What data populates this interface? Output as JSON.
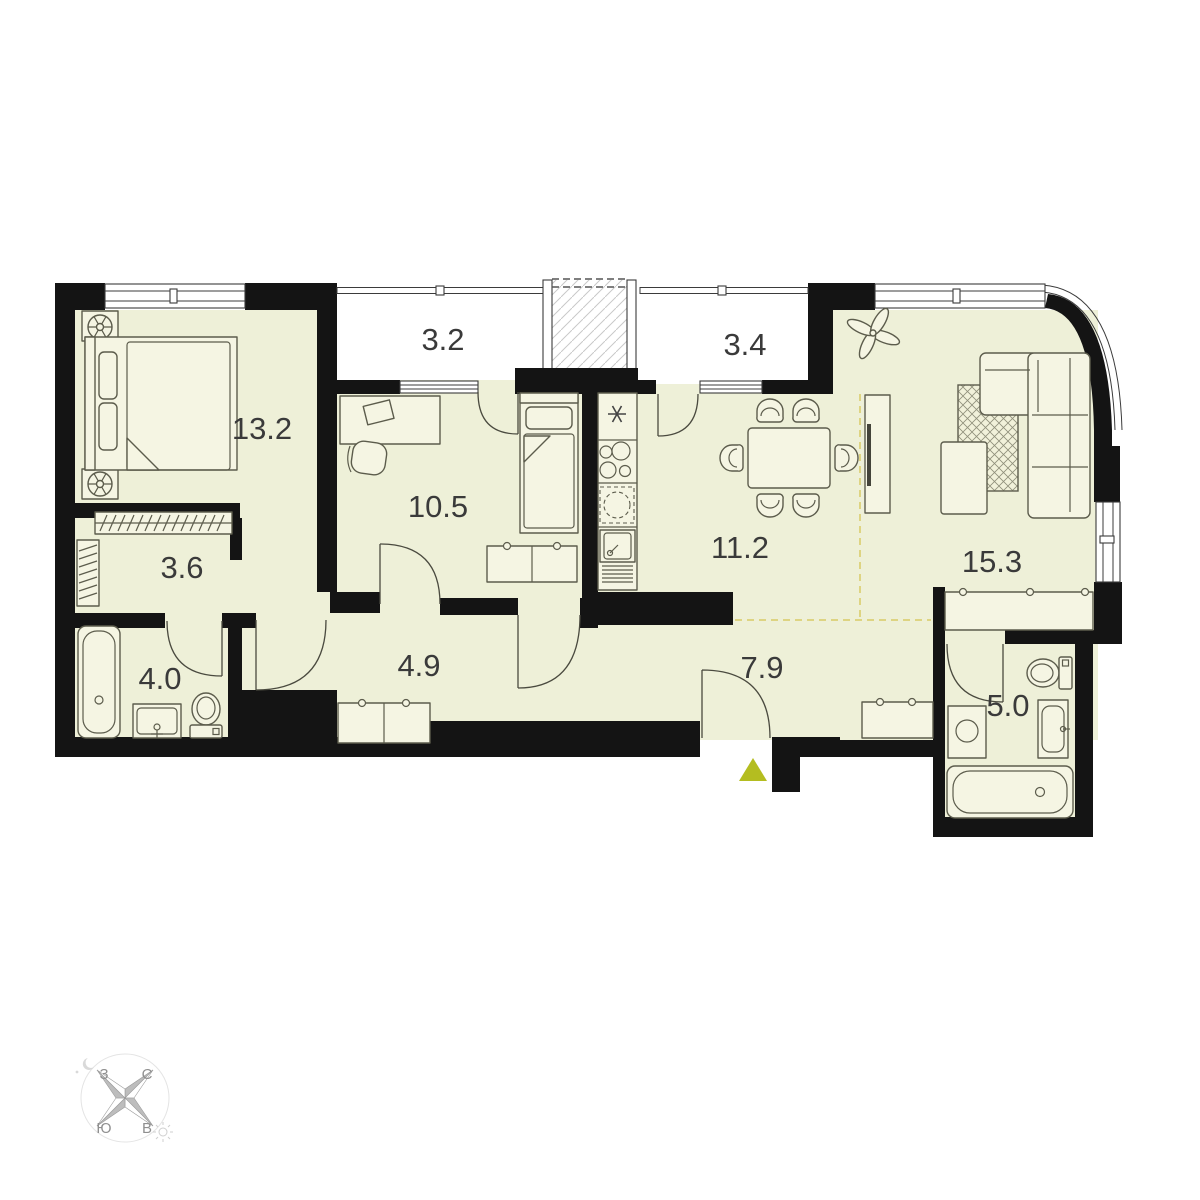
{
  "palette": {
    "floor": "#eef0d8",
    "wall": "#141414",
    "furniture": "#f5f5e3",
    "outline": "#5c5c4c",
    "accent_dash": "#d8ca66",
    "entrance": "#b4bd20",
    "label": "#3a3a3a"
  },
  "rooms": [
    {
      "name": "bedroom",
      "area": "13.2"
    },
    {
      "name": "balcony-left",
      "area": "3.2"
    },
    {
      "name": "balcony-right",
      "area": "3.4"
    },
    {
      "name": "bedroom-2",
      "area": "10.5"
    },
    {
      "name": "kitchen-dining",
      "area": "11.2"
    },
    {
      "name": "living-room",
      "area": "15.3"
    },
    {
      "name": "wardrobe",
      "area": "3.6"
    },
    {
      "name": "bathroom",
      "area": "4.0"
    },
    {
      "name": "hallway",
      "area": "4.9"
    },
    {
      "name": "corridor",
      "area": "7.9"
    },
    {
      "name": "bathroom-2",
      "area": "5.0"
    }
  ],
  "compass": {
    "north": "С",
    "east": "В",
    "south": "Ю",
    "west": "З"
  }
}
